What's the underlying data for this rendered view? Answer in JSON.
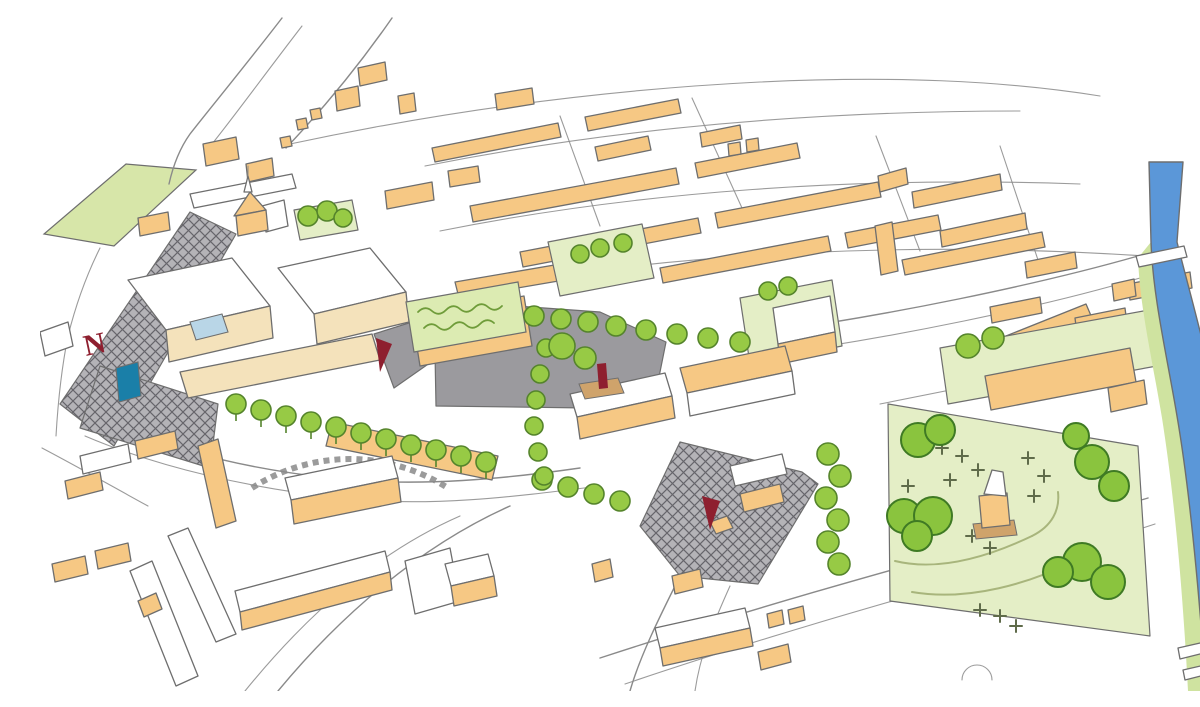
{
  "image": {
    "alt": "hand-drawn-aerial-masterplan-sketch-of-town-centre"
  },
  "north_marker": {
    "label": "N"
  },
  "colors": {
    "background": "#ffffff",
    "outline": "#8a8a8a",
    "outline2": "#6e6e6e",
    "building": "#f6c884",
    "cream": "#f4e2bb",
    "white": "#ffffff",
    "lawn": "#e4eec6",
    "field": "#d7e6a9",
    "greenRoof": "#dcebb2",
    "greenRoofScribble": "#6f9c3a",
    "tree": "#97ca45",
    "treeStroke": "#55842c",
    "parkTree": "#8ac43e",
    "parkTreeStroke": "#3f7a24",
    "plaza": "#9b9a9e",
    "hatchBase": "#b4b3b7",
    "hatchLine": "#66656b",
    "river": "#5b97d8",
    "bank": "#cfe3a0",
    "accent": "#8e1f2f",
    "tan": "#cfa36b",
    "canopyBlue": "#b9d6e7",
    "waterFeature": "#1a7fa8",
    "cross": "#5f6b4a",
    "parkPath": "#a8b57c"
  },
  "features": [
    {
      "name": "buildings",
      "color_key": "building"
    },
    {
      "name": "parks-and-lawns",
      "color_key": "lawn"
    },
    {
      "name": "street-trees",
      "color_key": "tree"
    },
    {
      "name": "pedestrian-plaza",
      "color_key": "plaza"
    },
    {
      "name": "hatched-shared-street",
      "color_key": "hatchBase"
    },
    {
      "name": "river",
      "color_key": "river"
    },
    {
      "name": "gateway-markers",
      "color_key": "accent"
    }
  ]
}
